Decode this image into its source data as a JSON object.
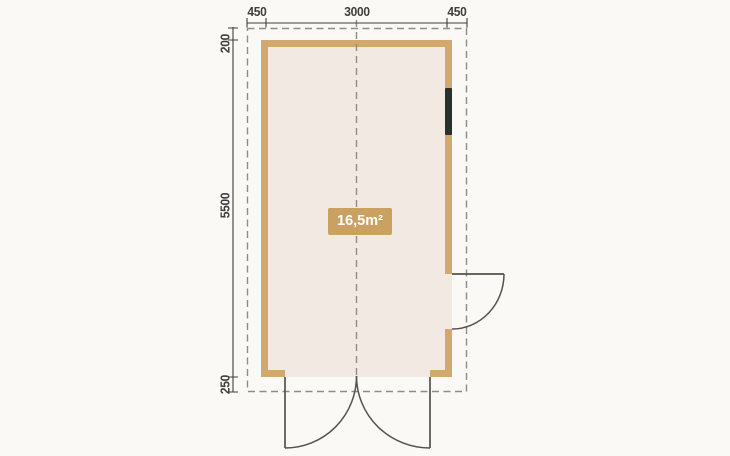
{
  "floor_plan": {
    "area_label": "16,5m²",
    "dimensions": {
      "top": [
        "450",
        "3000",
        "450"
      ],
      "left": [
        "200",
        "5500",
        "250"
      ]
    },
    "colors": {
      "background": "#FBF9F6",
      "wall": "#D2A96C",
      "floor": "#F2E9E2",
      "area_badge_bg": "#CBA161",
      "area_badge_text": "#FFFFFF",
      "dimension": "#3E3E3E",
      "dashed_outline": "#8C8C8C",
      "door_line": "#57514A",
      "window": "#28312B"
    }
  }
}
